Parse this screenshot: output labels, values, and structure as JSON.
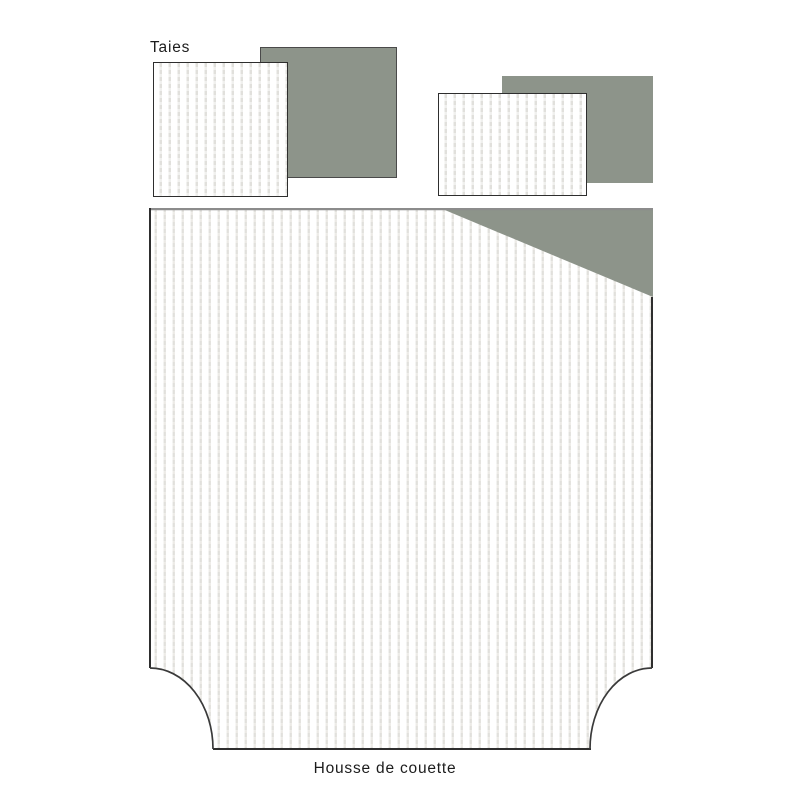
{
  "sections": {
    "pillowcases": {
      "label": "Taies"
    },
    "duvet": {
      "label": "Housse de couette"
    }
  },
  "colors": {
    "page_bg": "#ffffff",
    "fabric_green": "#8d948a",
    "fabric_white": "#ffffff",
    "stripe": "#e1e0dc",
    "stripe_light": "#eceae6",
    "border_dark": "#2e2e2e",
    "border_arc": "#3a3a3a",
    "border_top_gray": "#8c8c8c",
    "green_square_border": "#4a4a4a",
    "text": "#1c1c1c"
  }
}
